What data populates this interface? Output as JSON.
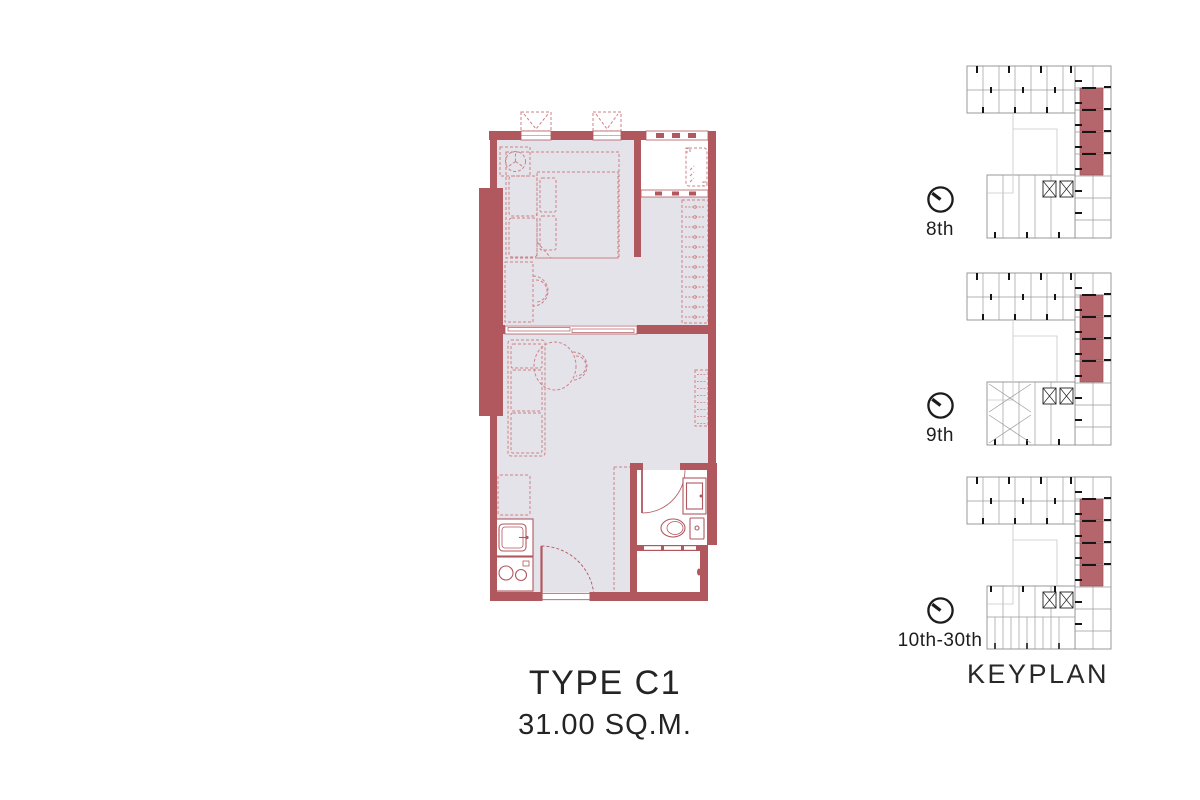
{
  "unit": {
    "type_label": "TYPE C1",
    "area_label": "31.00 SQ.M."
  },
  "keyplan": {
    "caption": "KEYPLAN",
    "floors": [
      {
        "label": "8th"
      },
      {
        "label": "9th"
      },
      {
        "label": "10th-30th"
      }
    ]
  },
  "colors": {
    "wall_red": "#b1585f",
    "furniture_line": "#cf8187",
    "floor_gray": "#e3e3e9",
    "keyplan_highlight": "#b4666c",
    "text": "#242424"
  }
}
